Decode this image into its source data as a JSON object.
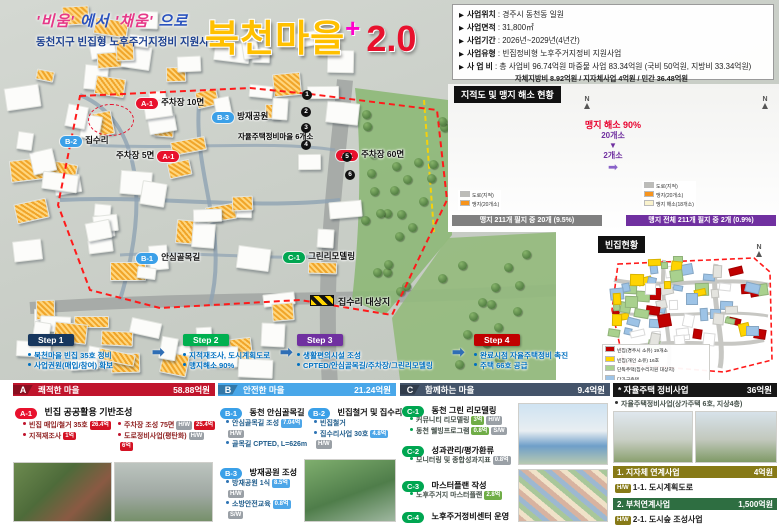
{
  "icons": {
    "bullet": "▶",
    "arrow": "➡",
    "down": "▼",
    "north": "N"
  },
  "header": {
    "slogan": [
      {
        "t": "'비움'"
      },
      {
        "t": "에서"
      },
      {
        "t": "'채움'"
      },
      {
        "t": "으로"
      }
    ],
    "subtitle": "동천지구 빈집형 노후주거지정비 지원사업",
    "title": "북천마을",
    "plus": "+",
    "version": "2.0"
  },
  "info": {
    "rows": [
      {
        "label": "사업위치",
        "value": ": 경주시 동천동 일원"
      },
      {
        "label": "사업면적",
        "value": ": 31,800㎡"
      },
      {
        "label": "사업기간",
        "value": ": 2026년~2029년(4년간)"
      },
      {
        "label": "사업유형",
        "value": ": 빈집정비형 노후주거지정비 지원사업"
      },
      {
        "label": "사 업 비",
        "value": ": 총 사업비 96.74억원 마중물 사업 83.34억원 (국비 50억원, 지방비 33.34억원)"
      }
    ],
    "subnote": "자체지방비 8.92억원 /  지자체사업 4억원  / 민간 36.48억원"
  },
  "map": {
    "markers": [
      {
        "code": "A-1",
        "label": "주차장 10면"
      },
      {
        "code": "B-3",
        "label": "방재공원"
      },
      {
        "code": "B-2",
        "label": "집수리"
      },
      {
        "code": "A-1",
        "label": "주차장 5면"
      },
      {
        "code": "A-1",
        "label": "주차장 60면"
      },
      {
        "code": "B-1",
        "label": "안심골목길"
      },
      {
        "code": "C-1",
        "label": "그린리모델링"
      }
    ],
    "annotation": "자율주택정비마을 6개소",
    "hazard": "집수리 대상지",
    "nums": [
      "1",
      "2",
      "3",
      "4",
      "5",
      "6"
    ]
  },
  "steps": [
    {
      "label": "Step 1",
      "lines": [
        "북천마을 빈집 35호 정비",
        "사업권원(매입/참여) 확보"
      ]
    },
    {
      "label": "Step 2",
      "lines": [
        "지적재조사, 도시계획도로",
        "맹지해소 90%"
      ]
    },
    {
      "label": "Step 3",
      "lines": [
        "생활편의시설 조성",
        "CPTED/안심골목길/주차장/그린리모델링"
      ]
    },
    {
      "label": "Step 4",
      "lines": [
        "완료시점 자율주택정비 촉진",
        "주택 66호 공급"
      ]
    }
  ],
  "cadastral": {
    "title": "지적도 및 맹지 해소 현황",
    "center": {
      "headline": "맹지 해소 90%",
      "from": "20개소",
      "to": "2개소"
    },
    "left": {
      "caption": "맹지 211개 필지 중 20개 (9.5%)",
      "legend": [
        {
          "label": "도로(지적)",
          "color": "#bcbcb8"
        },
        {
          "label": "맹지(20개소)",
          "color": "#f7941d"
        }
      ]
    },
    "right": {
      "caption": "맹지 전체 211개 필지 중 2개 (0.9%)",
      "legend": [
        {
          "label": "도로(지적)",
          "color": "#bcbcb8"
        },
        {
          "label": "맹지(20개소)",
          "color": "#f7941d"
        },
        {
          "label": "맹지 해소(18개소)",
          "color": "#faf3cd"
        }
      ]
    }
  },
  "vacant": {
    "title": "빈집현황",
    "legend": [
      {
        "label": "빈집(경주시 소유) 19개소",
        "color": "#c00000"
      },
      {
        "label": "빈집(개인 소유) 16호",
        "color": "#ffd400"
      },
      {
        "label": "단독주택(집수리지원 대상지)",
        "color": "#a9d18e"
      },
      {
        "label": "다가구주택",
        "color": "#9dc3e6"
      }
    ]
  },
  "sections": {
    "a": {
      "letter": "A",
      "title": "쾌적한 마을",
      "amount": "58.88억원",
      "sub_code": "A-1",
      "sub_title": "빈집 공공활용 기반조성",
      "bullets": [
        {
          "text": "빈집 매입/철거 35호",
          "badges": [
            "26.4억"
          ]
        },
        {
          "text": "지적재조사",
          "badges": [
            "1억"
          ]
        },
        {
          "text": "주차장 조성 75면",
          "badges": [
            "H/W",
            "25.4억"
          ]
        },
        {
          "text": "도로정비사업(평탄화)",
          "badges": [
            "H/W",
            "6억"
          ]
        }
      ]
    },
    "b": {
      "letter": "B",
      "title": "안전한 마을",
      "amount": "21.24억원",
      "subs": [
        {
          "code": "B-1",
          "title": "동천 안심골목길",
          "bullets": [
            {
              "text": "안심골목길 조성",
              "badges": [
                "7.04억",
                "H/W"
              ]
            },
            {
              "text": "골목길 CPTED, L=626m",
              "badges": []
            }
          ]
        },
        {
          "code": "B-2",
          "title": "빈집철거 및 집수리",
          "bullets": [
            {
              "text": "빈집철거",
              "badges": []
            },
            {
              "text": "집수리사업 30호",
              "badges": [
                "4.8억",
                "H/W"
              ]
            }
          ]
        },
        {
          "code": "B-3",
          "title": "방재공원 조성",
          "bullets": [
            {
              "text": "방재공원 1식",
              "badges": [
                "8.5억",
                "H/W"
              ]
            },
            {
              "text": "소방안전교육",
              "badges": [
                "0.8억",
                "S/W"
              ]
            }
          ]
        }
      ]
    },
    "c": {
      "letter": "C",
      "title": "함께하는 마을",
      "amount": "9.4억원",
      "subs": [
        {
          "code": "C-1",
          "title": "동천 그린 리모델링",
          "bullets": [
            {
              "text": "커뮤니티 리모델링",
              "badges": [
                "3억",
                "H/W"
              ]
            },
            {
              "text": "동천 웰빙프로그램",
              "badges": [
                "0.8억",
                "S/W"
              ]
            }
          ]
        },
        {
          "code": "C-2",
          "title": "성과관리/평가환류",
          "bullets": [
            {
              "text": "모니터링 및 종합성과지표",
              "badges": [
                "0.8억"
              ]
            }
          ]
        },
        {
          "code": "C-3",
          "title": "마스터플랜 작성",
          "bullets": [
            {
              "text": "노후주거지 마스터플랜",
              "badges": [
                "2.8억"
              ]
            }
          ]
        },
        {
          "code": "C-4",
          "title": "노후주거정비센터 운영",
          "bullets": []
        }
      ]
    },
    "d": {
      "title": "* 자율주택 정비사업",
      "amount": "36억원",
      "bullet": "자율주택정비사업(상가주택 6호, 지상4층)",
      "links": [
        {
          "title": "1. 지자체 연계사업",
          "amount": "4억원",
          "tag": "H/W",
          "item": "1-1. 도시계획도로"
        },
        {
          "title": "2. 부처연계사업",
          "amount": "1,500억원",
          "tag": "H/W",
          "item": "2-1. 도시숲 조성사업"
        }
      ]
    }
  },
  "colors": {
    "accent_a": "#c0142c",
    "accent_b": "#49a7e9",
    "accent_c": "#44546a",
    "accent_d": "#161616",
    "link1": "#877a17",
    "link2": "#2e6e41",
    "step1": "#17375e",
    "step2": "#00b050",
    "step3": "#7030a0",
    "step4": "#c00000",
    "title_yellow": "#ffc000",
    "title_red": "#e8112d",
    "plus_pink": "#ff00cc"
  }
}
